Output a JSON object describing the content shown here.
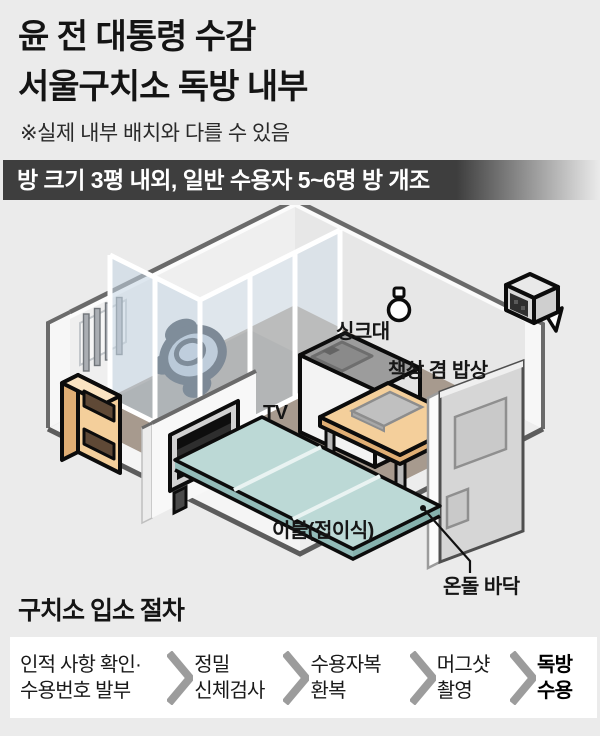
{
  "header": {
    "title_line1": "윤 전 대통령 수감",
    "title_line2": "서울구치소 독방 내부",
    "disclaimer": "※실제 내부 배치와 다를 수 있음",
    "banner": "방 크기 3평 내외, 일반 수용자 5~6명 방 개조"
  },
  "diagram": {
    "labels": {
      "sink": "싱크대",
      "desk": "책상 겸 밥상",
      "tv": "TV",
      "blanket": "이불(접이식)",
      "floor": "온돌 바닥"
    },
    "icons": [
      "light-bulb-icon",
      "cctv-camera-icon",
      "barred-window",
      "toilet"
    ]
  },
  "procedure": {
    "heading": "구치소 입소 절차",
    "steps": [
      {
        "line1": "인적 사항 확인·",
        "line2": "수용번호 발부"
      },
      {
        "line1": "정밀",
        "line2": "신체검사"
      },
      {
        "line1": "수용자복",
        "line2": "환복"
      },
      {
        "line1": "머그샷",
        "line2": "촬영"
      },
      {
        "line1": "독방",
        "line2": "수용"
      }
    ]
  },
  "colors": {
    "bg": "#ebebeb",
    "ink": "#141414",
    "banner_bg": "#3e3e3e",
    "banner_text": "#ffffff",
    "wall": "#e7e7e7",
    "wall_light": "#efefef",
    "trim": "#6a6a6a",
    "slab_trim": "#5c5c5c",
    "floor": "#a79a8e",
    "floor_inner": "#968c82",
    "glass": "#c5d6e4",
    "glass2": "#cfdde9",
    "toilet": "#2b3542",
    "toilet_fill": "#aebdcd",
    "wood": "#f4cf9b",
    "wood_dark": "#e0ae74",
    "wood_light": "#fbe4c2",
    "metal": "#b9b9b9",
    "sink_top": "#9c9c9c",
    "unit_white": "#f3f3f3",
    "door": "#d6d6d6",
    "door_panel": "#c9c9c9",
    "blanket": "#bcd9d6",
    "blanket_side": "#93bcb9",
    "blanket_stripe": "#e9f3f2",
    "tv_screen": "#0e0e0e",
    "tv_frame": "#d2d2d2",
    "chevron": "#9c9c9c",
    "box_bg": "#ffffff",
    "outline": "#0c0c0c"
  }
}
